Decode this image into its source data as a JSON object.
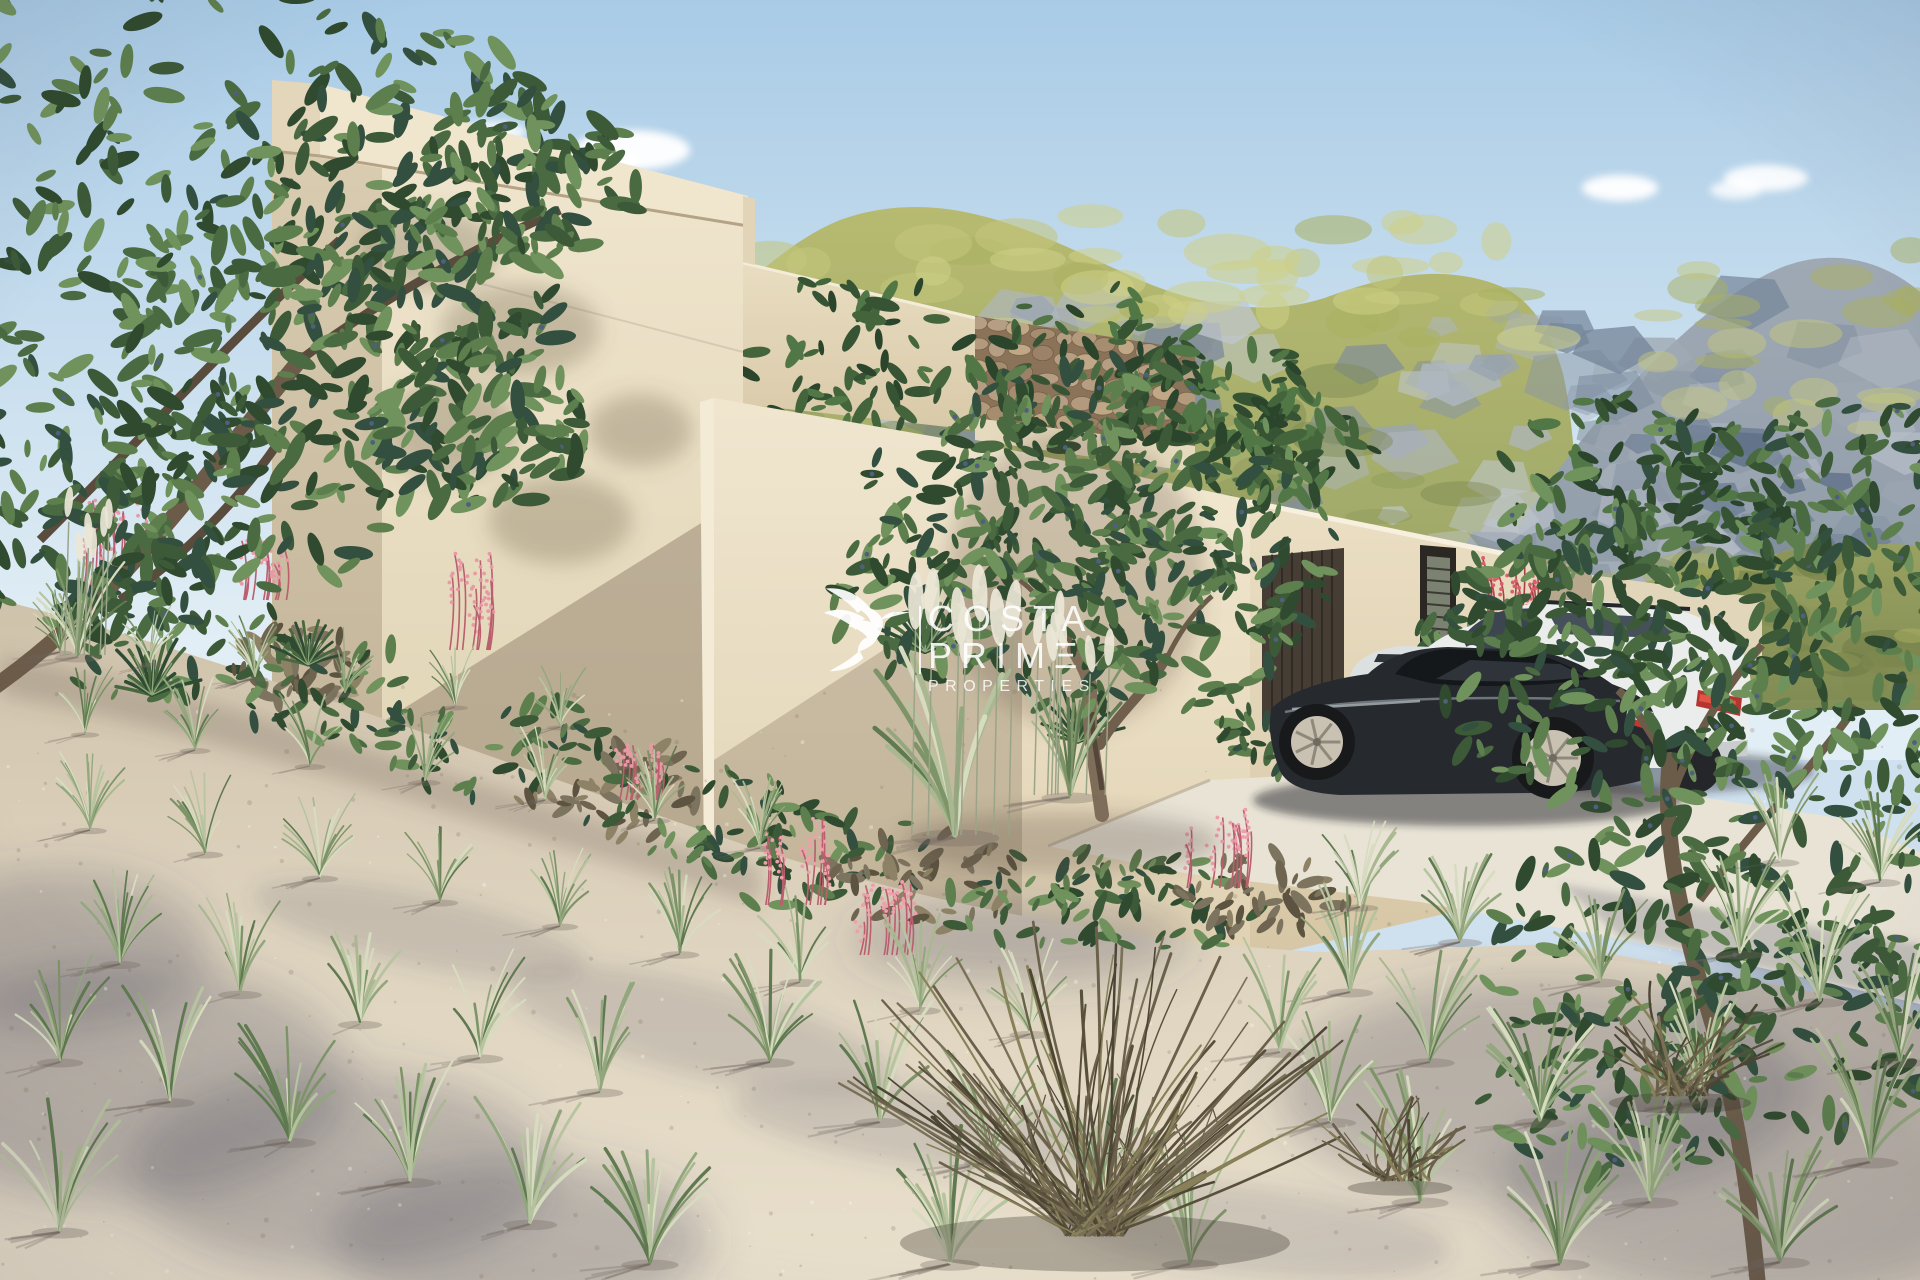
{
  "image": {
    "kind": "3d-architectural-exterior-render",
    "subject": "modern flat-roof cubic villa with olive trees, mountain backdrop and parked cars"
  },
  "watermark": {
    "icon": "hummingbird-icon",
    "line1": "COSTA",
    "line2": "PRIME",
    "line3": "PROPERTIES",
    "text_color": "#ffffff"
  },
  "vehicles": [
    {
      "name": "dark-grey-sports-coupe",
      "color": "#26292e"
    },
    {
      "name": "white-suv",
      "color": "#ebedec"
    },
    {
      "name": "silver-car",
      "color": "#dde0e0"
    }
  ],
  "palette": {
    "sky-top": "#a9cbe6",
    "sky-low": "#e2eef5",
    "mtn-grass": "#b7ba70",
    "mtn-grass-dark": "#99a468",
    "mtn-rock": "#9fa9b4",
    "mtn-rock-dark": "#8c99a6",
    "hill-green": "#9aa25e",
    "wall-lit": "#efe5cd",
    "wall-mid": "#e0d3b6",
    "wall-shade": "#b7a78d",
    "wall-dark": "#a5947c",
    "roof-fascia": "#e3d6ba",
    "stone-wall": "#8a7358",
    "garage-door": "#463e35",
    "window-frame": "#2b2722",
    "sand": "#e8dfcc",
    "sand-far": "#cfc2ab",
    "driveway": "#e8e3d5",
    "foliage-dark": "#2f4a2e",
    "foliage-light": "#70925c",
    "grass-green": "#7d9468",
    "grass-pale": "#d7dcc0",
    "dry-bush": "#6b604a",
    "flower-pink": "#e08a97",
    "car-dark": "#26292e",
    "car-white": "#ebedec",
    "car-silver": "#dde0e0",
    "shadow-tint": "#5c5668"
  }
}
